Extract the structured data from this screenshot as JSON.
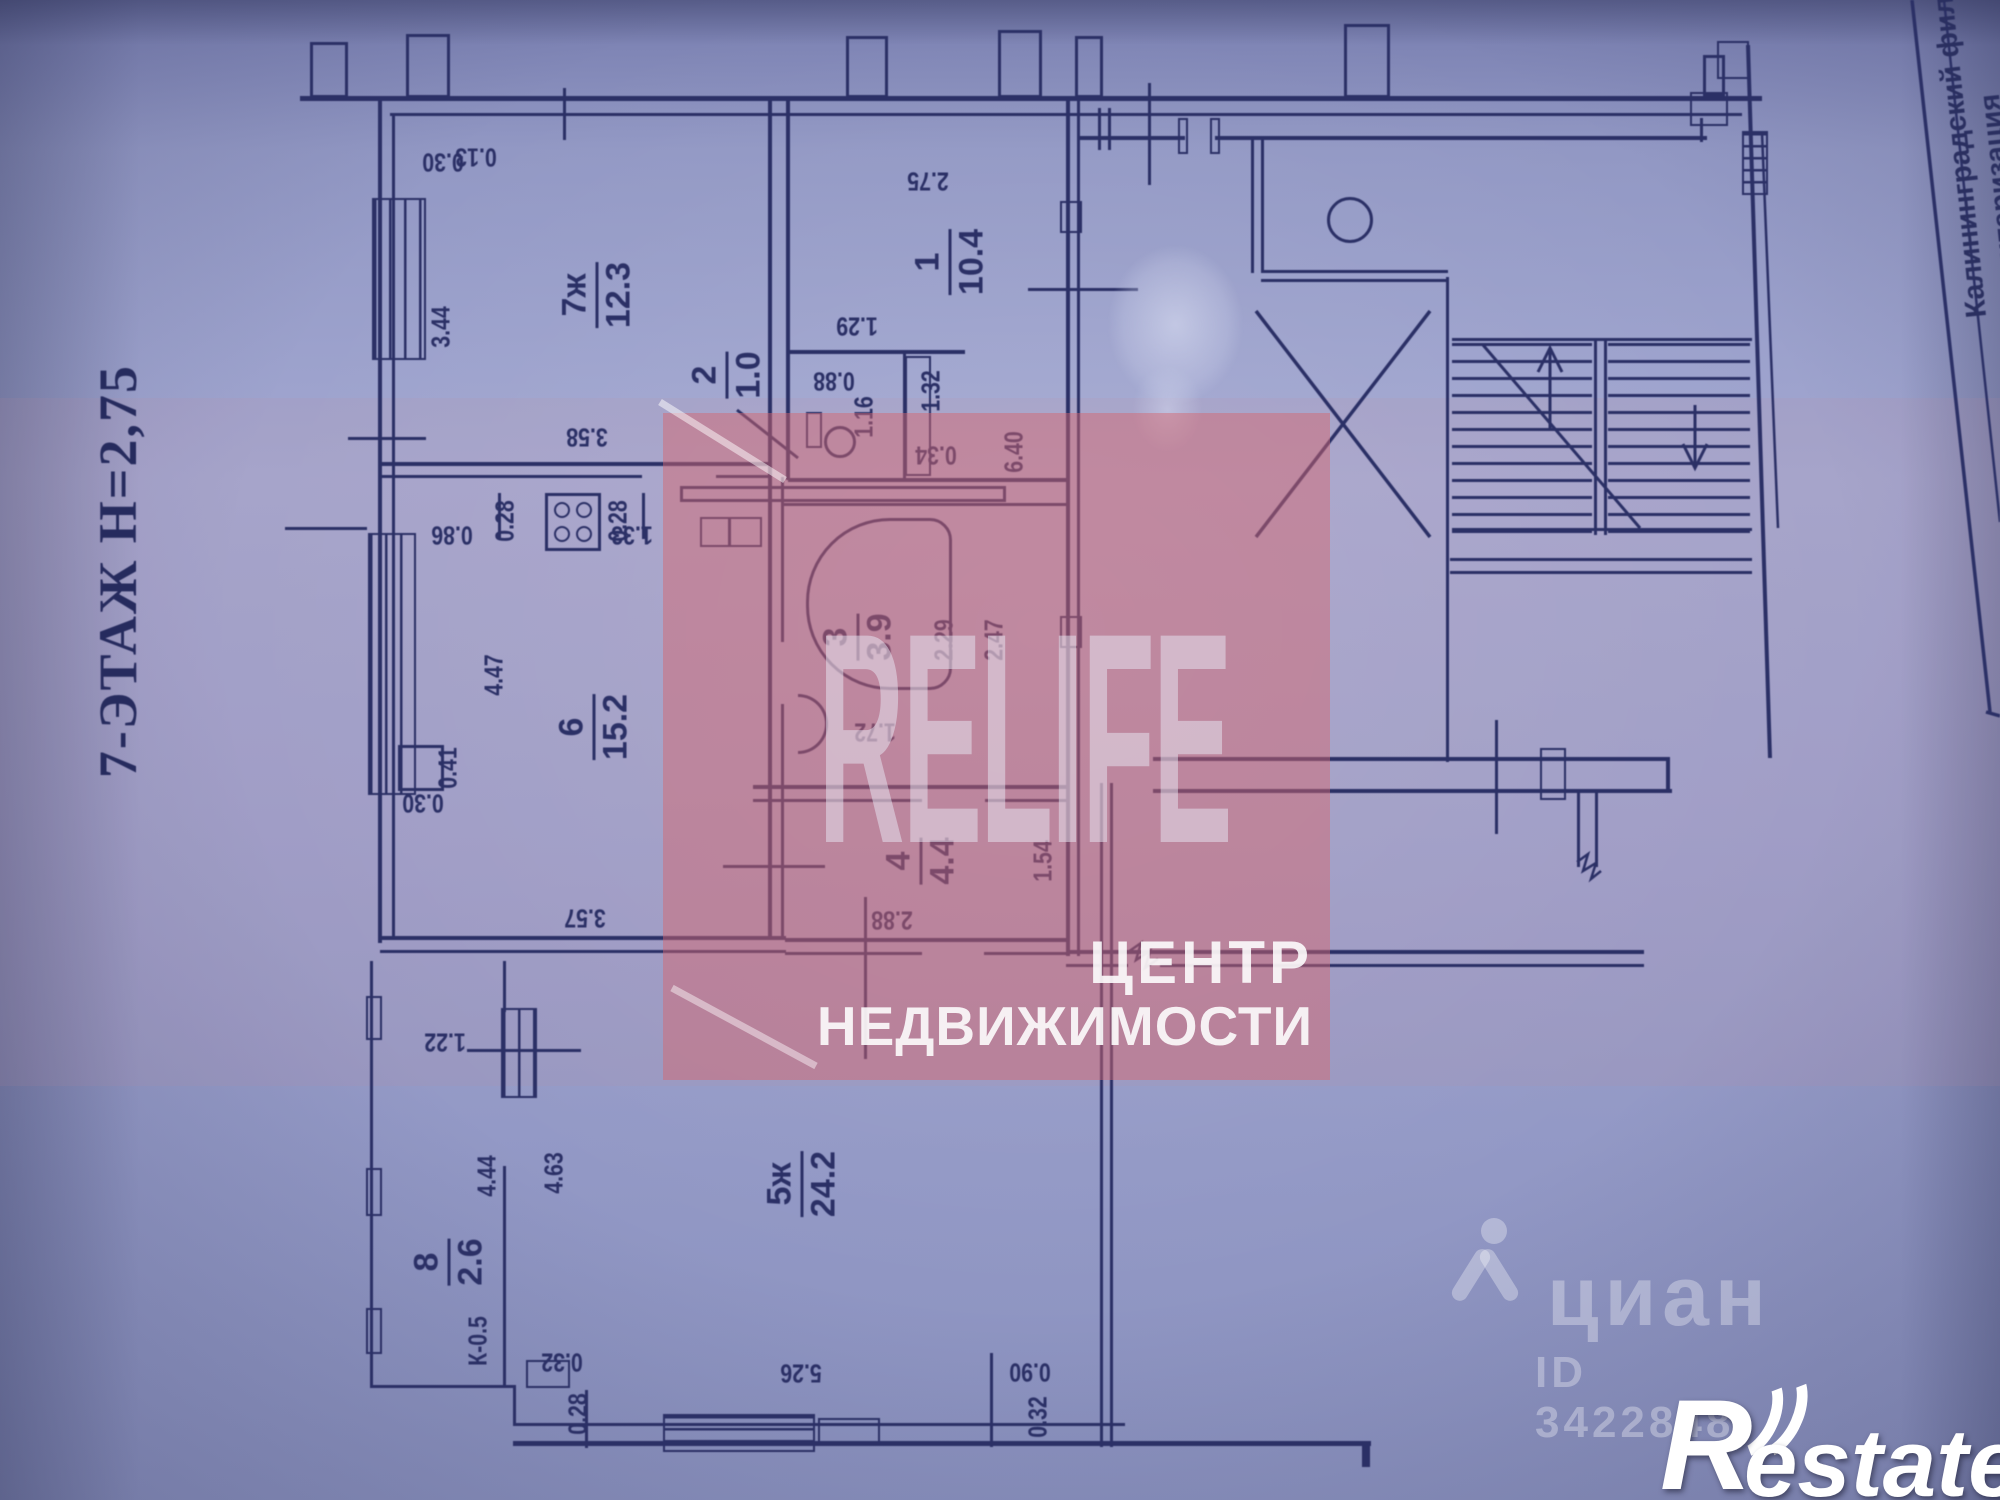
{
  "photo": {
    "floor_title": "7-ЭТАЖ Н=2,75",
    "stamp_vertical_text": "Калининградский филиал",
    "stamp_vertical_text2_partial": "нтаризация"
  },
  "watermark_agency": {
    "brand": "RELIFE",
    "line1": "ЦЕНТР",
    "line2": "НЕДВИЖИМОСТИ",
    "accent_color": "#d5676e"
  },
  "watermark_cian": {
    "brand": "циан",
    "listing_id": "ID 3422848"
  },
  "watermark_restate": {
    "brand_r": "R",
    "brand_rest": "estate"
  },
  "plan": {
    "rooms": [
      {
        "num": "7ж",
        "area": "12.3",
        "x": 597,
        "y": 295
      },
      {
        "num": "1",
        "area": "10.4",
        "x": 950,
        "y": 262
      },
      {
        "num": "2",
        "area": "1.0",
        "x": 727,
        "y": 375
      },
      {
        "num": "3",
        "area": "3.9",
        "x": 858,
        "y": 637
      },
      {
        "num": "4",
        "area": "4.4",
        "x": 921,
        "y": 861
      },
      {
        "num": "6",
        "area": "15.2",
        "x": 594,
        "y": 727
      },
      {
        "num": "5ж",
        "area": "24.2",
        "x": 802,
        "y": 1184
      },
      {
        "num": "8",
        "area": "2.6",
        "x": 449,
        "y": 1262
      }
    ],
    "dimensions": [
      {
        "t": "0.30",
        "x": 443,
        "y": 162,
        "r": "f"
      },
      {
        "t": "0.13",
        "x": 476,
        "y": 157,
        "r": "f"
      },
      {
        "t": "3.44",
        "x": 441,
        "y": 327,
        "r": "v"
      },
      {
        "t": "3.58",
        "x": 587,
        "y": 437,
        "r": "f"
      },
      {
        "t": "2.75",
        "x": 928,
        "y": 181,
        "r": "f"
      },
      {
        "t": "1.29",
        "x": 857,
        "y": 326,
        "r": "f"
      },
      {
        "t": "0.88",
        "x": 834,
        "y": 381,
        "r": "f"
      },
      {
        "t": "1.16",
        "x": 864,
        "y": 417,
        "r": "v"
      },
      {
        "t": "1.32",
        "x": 931,
        "y": 391,
        "r": "v"
      },
      {
        "t": "0.34",
        "x": 936,
        "y": 455,
        "r": "f"
      },
      {
        "t": "6.40",
        "x": 1014,
        "y": 452,
        "r": "v"
      },
      {
        "t": "2.29",
        "x": 944,
        "y": 640,
        "r": "v"
      },
      {
        "t": "2.47",
        "x": 994,
        "y": 640,
        "r": "v"
      },
      {
        "t": "1.72",
        "x": 875,
        "y": 732,
        "r": "f"
      },
      {
        "t": "1.54",
        "x": 1043,
        "y": 861,
        "r": "v"
      },
      {
        "t": "2.88",
        "x": 892,
        "y": 920,
        "r": "f"
      },
      {
        "t": "1.33",
        "x": 632,
        "y": 535,
        "r": "f"
      },
      {
        "t": "0.28",
        "x": 505,
        "y": 521,
        "r": "v"
      },
      {
        "t": "0.28",
        "x": 618,
        "y": 521,
        "r": "v"
      },
      {
        "t": "0.86",
        "x": 452,
        "y": 535,
        "r": "f"
      },
      {
        "t": "4.47",
        "x": 494,
        "y": 675,
        "r": "v"
      },
      {
        "t": "0.41",
        "x": 448,
        "y": 768,
        "r": "v"
      },
      {
        "t": "0.30",
        "x": 423,
        "y": 803,
        "r": "f"
      },
      {
        "t": "3.57",
        "x": 585,
        "y": 918,
        "r": "f"
      },
      {
        "t": "1.22",
        "x": 445,
        "y": 1042,
        "r": "f"
      },
      {
        "t": "4.44",
        "x": 487,
        "y": 1176,
        "r": "v"
      },
      {
        "t": "4.63",
        "x": 554,
        "y": 1173,
        "r": "v"
      },
      {
        "t": "К-0.5",
        "x": 478,
        "y": 1341,
        "r": "v"
      },
      {
        "t": "0.32",
        "x": 562,
        "y": 1362,
        "r": "f"
      },
      {
        "t": "0.28",
        "x": 578,
        "y": 1414,
        "r": "v"
      },
      {
        "t": "5.26",
        "x": 801,
        "y": 1373,
        "r": "f"
      },
      {
        "t": "0.90",
        "x": 1030,
        "y": 1372,
        "r": "f"
      },
      {
        "t": "0.32",
        "x": 1038,
        "y": 1417,
        "r": "v"
      }
    ]
  }
}
